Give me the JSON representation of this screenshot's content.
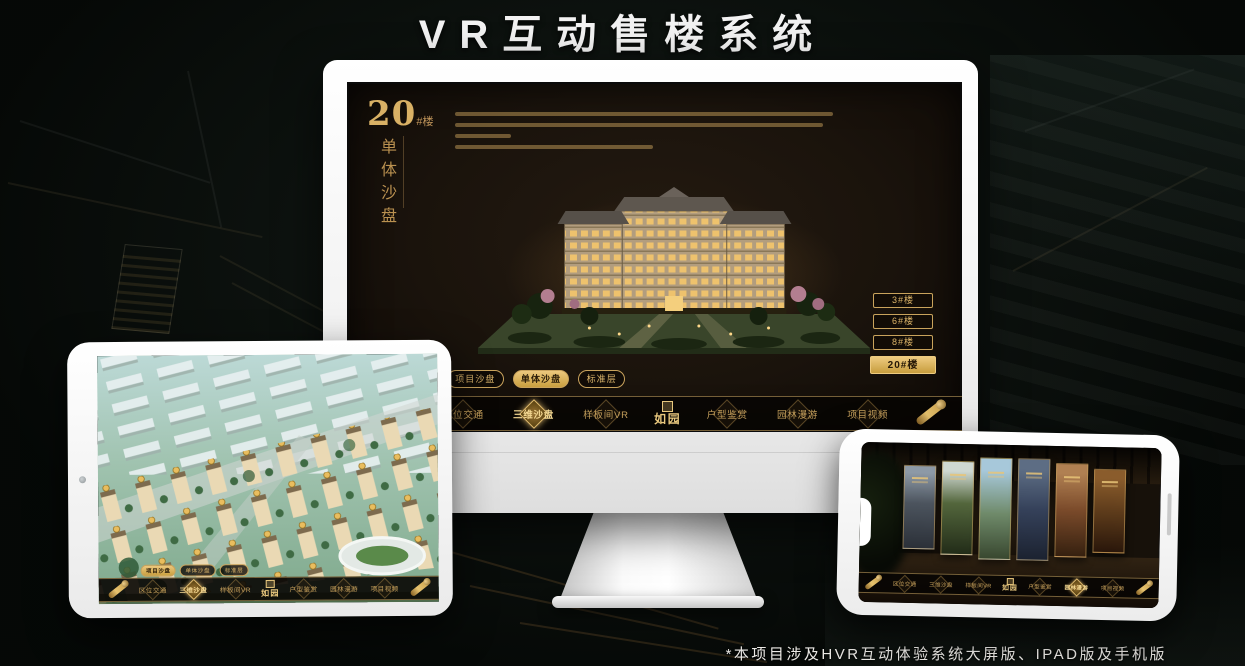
{
  "page": {
    "title": "VR互动售楼系统",
    "footnote": "*本项目涉及HVR互动体验系统大屏版、IPAD版及手机版"
  },
  "colors": {
    "gold": "#d2a75f",
    "gold_bright": "#ecc87e",
    "screen_bg": "#1a130c",
    "page_bg": "#0b100d",
    "title_white": "#f2f2f2"
  },
  "monitor_app": {
    "heading": {
      "number": "20",
      "suffix": "#楼",
      "subtitle_vertical": "单体沙盘"
    },
    "building_buttons": [
      {
        "label": "3#楼",
        "selected": false
      },
      {
        "label": "6#楼",
        "selected": false
      },
      {
        "label": "8#楼",
        "selected": false
      },
      {
        "label": "20#楼",
        "selected": true
      }
    ],
    "sub_tabs": [
      {
        "label": "项目沙盘",
        "selected": false
      },
      {
        "label": "单体沙盘",
        "selected": true
      },
      {
        "label": "标准层",
        "selected": false
      }
    ],
    "nav_left": [
      {
        "label": "区位交通",
        "selected": false
      },
      {
        "label": "三维沙盘",
        "selected": true
      },
      {
        "label": "样板间VR",
        "selected": false
      }
    ],
    "logo": "如园",
    "nav_right": [
      {
        "label": "户型鉴赏",
        "selected": false
      },
      {
        "label": "园林漫游",
        "selected": false
      },
      {
        "label": "项目视频",
        "selected": false
      }
    ]
  },
  "tablet_app": {
    "sub_tabs": [
      {
        "label": "项目沙盘",
        "selected": true
      },
      {
        "label": "单体沙盘",
        "selected": false
      },
      {
        "label": "标准层",
        "selected": false
      }
    ],
    "nav_left": [
      {
        "label": "区位交通",
        "selected": false
      },
      {
        "label": "三维沙盘",
        "selected": true
      },
      {
        "label": "样板间VR",
        "selected": false
      }
    ],
    "logo": "如园",
    "nav_right": [
      {
        "label": "户型鉴赏",
        "selected": false
      },
      {
        "label": "园林漫游",
        "selected": false
      },
      {
        "label": "项目视频",
        "selected": false
      }
    ]
  },
  "phone_app": {
    "nav_left": [
      {
        "label": "区位交通",
        "selected": false
      },
      {
        "label": "三维沙盘",
        "selected": false
      },
      {
        "label": "样板间VR",
        "selected": false
      }
    ],
    "logo": "如园",
    "nav_right": [
      {
        "label": "户型鉴赏",
        "selected": false
      },
      {
        "label": "园林漫游",
        "selected": true
      },
      {
        "label": "项目视频",
        "selected": false
      }
    ]
  }
}
